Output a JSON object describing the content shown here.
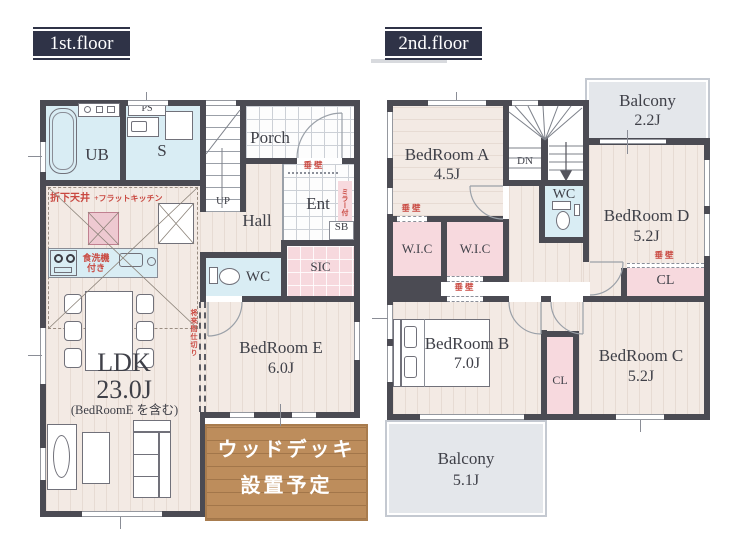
{
  "colors": {
    "wall": "#4b4b53",
    "floor_beige": "#f3eae4",
    "floor_stripe": "#e7dbd3",
    "wet_blue": "#d9edf4",
    "storage_pink": "#f7d9de",
    "island_pink": "#eec9d1",
    "balcony_gray": "#e4e7eb",
    "wood_brown": "#bd8d5c",
    "title_navy": "#2f3347",
    "note_red": "#c94840",
    "line_gray": "#8a8d96"
  },
  "floor1": {
    "title": "1st.floor",
    "rooms": {
      "ub": "UB",
      "s": "S",
      "ps": "PS",
      "porch": "Porch",
      "ent": "Ent",
      "sb": "SB",
      "sic": "SIC",
      "hall": "Hall",
      "wc": "WC",
      "ldk": {
        "name": "LDK",
        "size": "23.0J",
        "note": "(BedRoomE を含む)"
      },
      "bedroom_e": {
        "name": "BedRoom E",
        "size": "6.0J"
      }
    },
    "stairs": {
      "up": "UP"
    },
    "notes": {
      "ceiling_1": "折下天井",
      "ceiling_2": "+フラットキッチン",
      "dishwasher_1": "食洗機",
      "dishwasher_2": "付き",
      "mirror": "ミラー付",
      "hanging_wall": "垂壁",
      "future_partition": "将来間仕切り"
    },
    "wood_deck": {
      "line1": "ウッドデッキ",
      "line2": "設置予定"
    }
  },
  "floor2": {
    "title": "2nd.floor",
    "stairs": {
      "down": "DN"
    },
    "rooms": {
      "bedroom_a": {
        "name": "BedRoom A",
        "size": "4.5J"
      },
      "bedroom_b": {
        "name": "BedRoom B",
        "size": "7.0J"
      },
      "bedroom_c": {
        "name": "BedRoom C",
        "size": "5.2J"
      },
      "bedroom_d": {
        "name": "BedRoom D",
        "size": "5.2J"
      },
      "balcony_top": {
        "name": "Balcony",
        "size": "2.2J"
      },
      "balcony_bottom": {
        "name": "Balcony",
        "size": "5.1J"
      },
      "wc": "WC",
      "wic": "W.I.C",
      "cl": "CL"
    },
    "notes": {
      "hanging_wall": "垂壁"
    }
  }
}
